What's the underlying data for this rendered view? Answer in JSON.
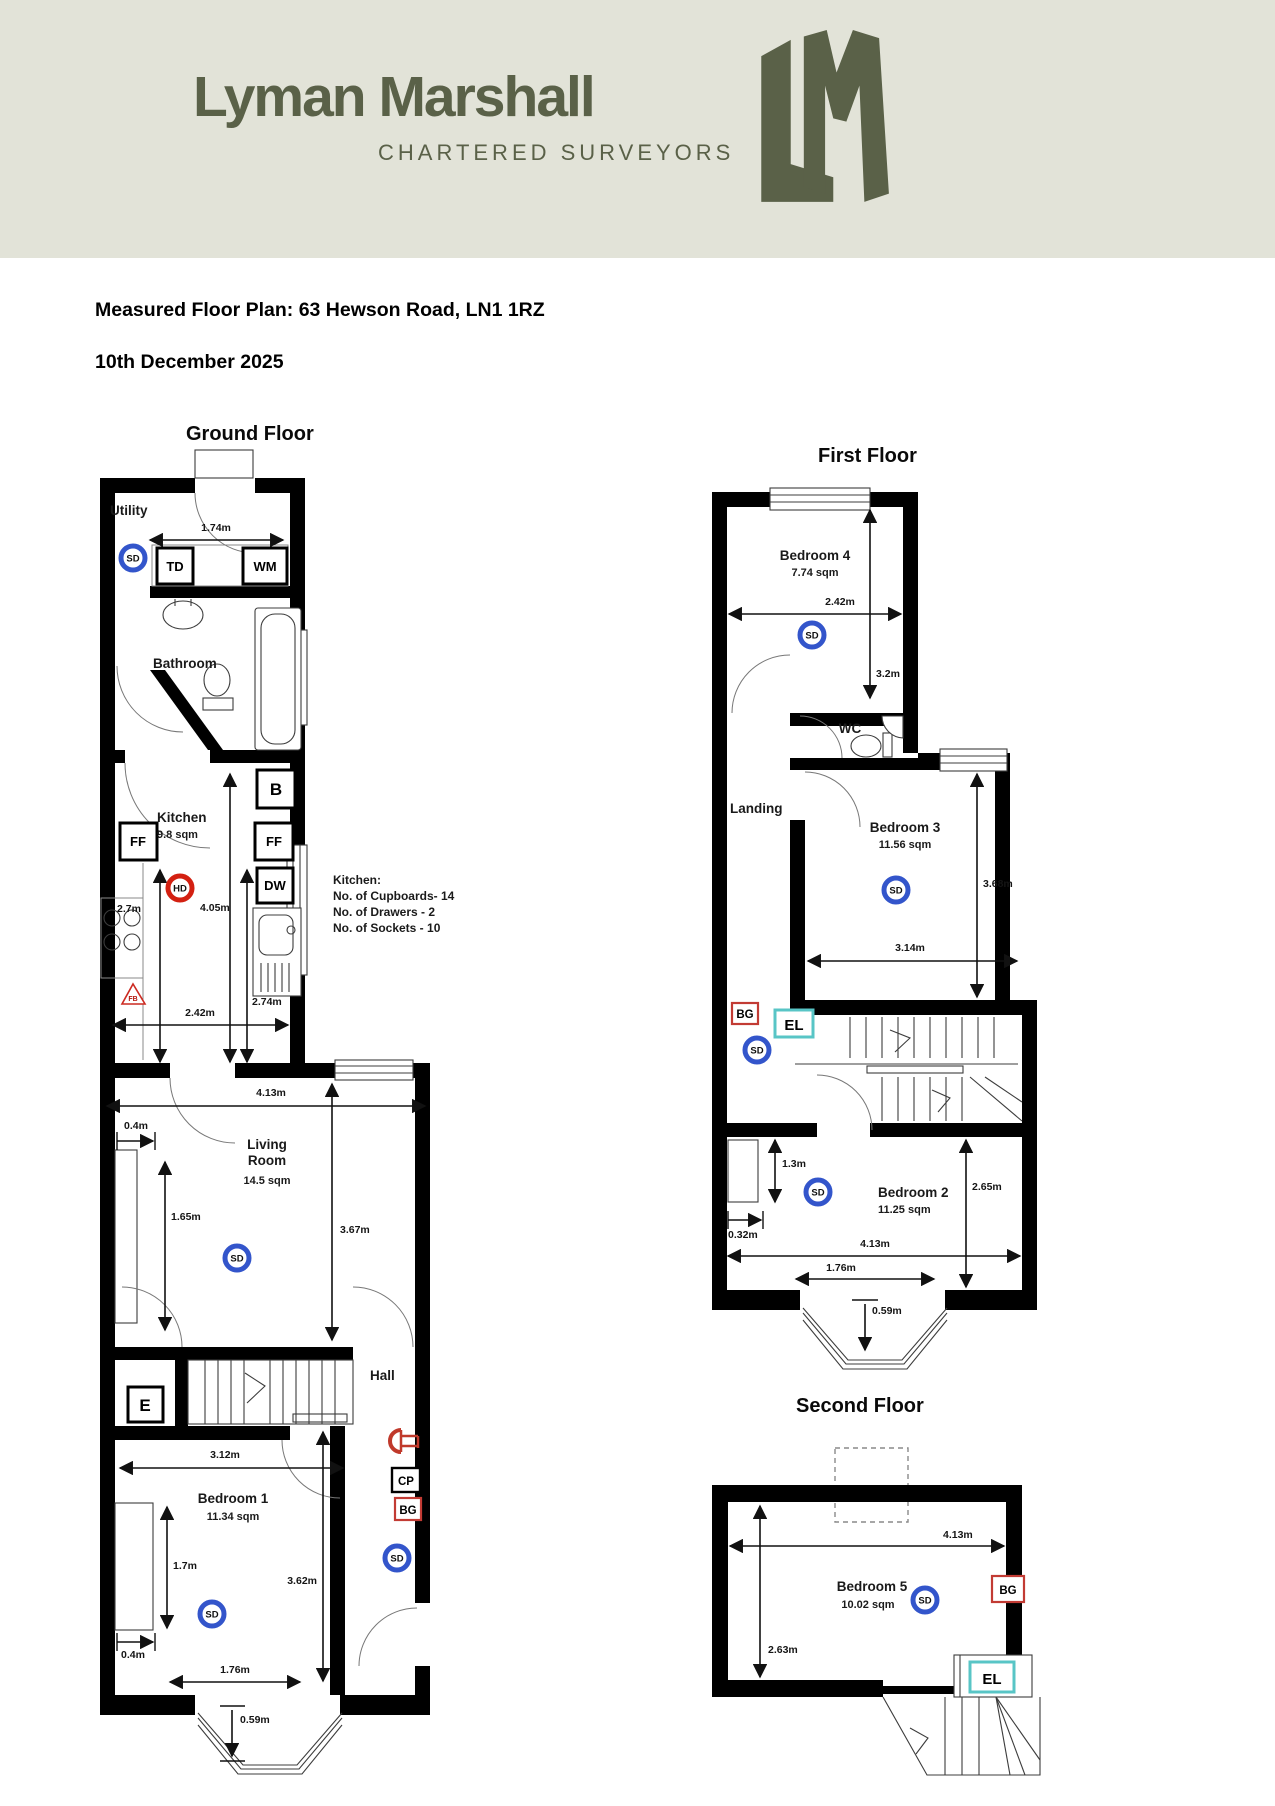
{
  "header": {
    "brand": "Lyman Marshall",
    "tagline": "CHARTERED SURVEYORS"
  },
  "doc": {
    "title": "Measured Floor Plan: 63 Hewson Road, LN1 1RZ",
    "date": "10th December 2025"
  },
  "notes": {
    "title": "Kitchen:",
    "l1": "No. of Cupboards- 14",
    "l2": "No. of Drawers - 2",
    "l3": "No. of Sockets - 10"
  },
  "sym": {
    "sd": "SD",
    "hd": "HD",
    "td": "TD",
    "wm": "WM",
    "b": "B",
    "ff": "FF",
    "dw": "DW",
    "e": "E",
    "cp": "CP",
    "bg": "BG",
    "el": "EL",
    "fb": "FB"
  },
  "colors": {
    "brand": "#5a6148",
    "header_bg": "#e2e3d8",
    "smoke_detector": "#3355cb",
    "heat_detector": "#d32011",
    "bg_box": "#c23b34",
    "el_box": "#58c5c6"
  },
  "gf": {
    "title": "Ground Floor",
    "utility": "Utility",
    "bathroom": "Bathroom",
    "kitchen": "Kitchen",
    "kitchen_area": "9.8 sqm",
    "living1": "Living",
    "living2": "Room",
    "living_area": "14.5 sqm",
    "hall": "Hall",
    "bed1": "Bedroom 1",
    "bed1_area": "11.34 sqm",
    "d1": "1.74m",
    "d2": "2.7m",
    "d3": "4.05m",
    "d4": "2.74m",
    "d5": "2.42m",
    "d6": "4.13m",
    "d7": "0.4m",
    "d8": "1.65m",
    "d9": "3.67m",
    "d10": "3.12m",
    "d11": "1.7m",
    "d12": "3.62m",
    "d13": "0.4m",
    "d14": "1.76m",
    "d15": "0.59m"
  },
  "ff": {
    "title": "First Floor",
    "bed4": "Bedroom 4",
    "bed4_area": "7.74 sqm",
    "wc": "WC",
    "landing": "Landing",
    "bed3": "Bedroom 3",
    "bed3_area": "11.56 sqm",
    "bed2": "Bedroom 2",
    "bed2_area": "11.25 sqm",
    "d1": "2.42m",
    "d2": "3.2m",
    "d3": "3.68m",
    "d4": "3.14m",
    "d5": "1.3m",
    "d6": "0.32m",
    "d7": "2.65m",
    "d8": "4.13m",
    "d9": "1.76m",
    "d10": "0.59m"
  },
  "sf": {
    "title": "Second Floor",
    "bed5": "Bedroom 5",
    "bed5_area": "10.02 sqm",
    "d1": "4.13m",
    "d2": "2.63m"
  }
}
